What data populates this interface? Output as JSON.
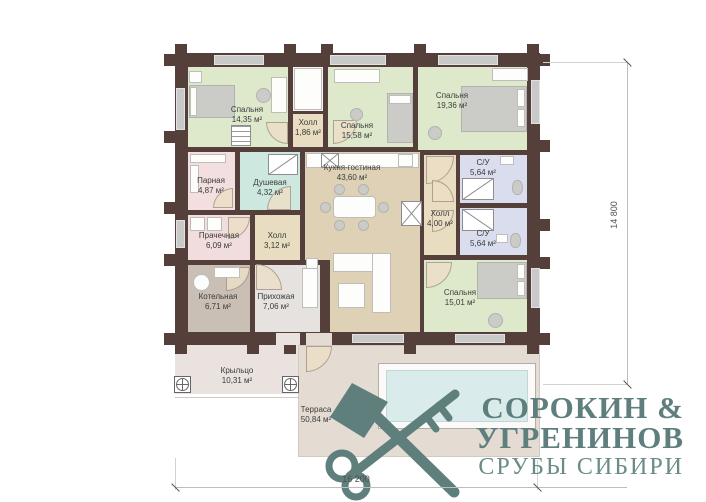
{
  "plan": {
    "rooms": [
      {
        "name": "Спальня",
        "area": "14,35 м²"
      },
      {
        "name": "Холл",
        "area": "1,86 м²"
      },
      {
        "name": "Спальня",
        "area": "15,58 м²"
      },
      {
        "name": "Спальня",
        "area": "19,36 м²"
      },
      {
        "name": "Парная",
        "area": "4,87 м²"
      },
      {
        "name": "Душевая",
        "area": "4,32 м²"
      },
      {
        "name": "Кухня-гостиная",
        "area": "43,60 м²"
      },
      {
        "name": "С/У",
        "area": "5,64 м²"
      },
      {
        "name": "Холл",
        "area": "4,00 м²"
      },
      {
        "name": "С/У",
        "area": "5,64 м²"
      },
      {
        "name": "Прачечная",
        "area": "6,09 м²"
      },
      {
        "name": "Холл",
        "area": "3,12 м²"
      },
      {
        "name": "Котельная",
        "area": "6,71 м²"
      },
      {
        "name": "Прихожая",
        "area": "7,06 м²"
      },
      {
        "name": "Спальня",
        "area": "15,01 м²"
      },
      {
        "name": "Крыльцо",
        "area": "10,31 м²"
      },
      {
        "name": "Терраса",
        "area": "50,84 м²"
      }
    ],
    "dimensions": {
      "vertical": "14 800",
      "horizontal": "16 200"
    }
  },
  "logo": {
    "name_line1": "СОРОКИН &",
    "name_line2": "УГРЕНИНОВ",
    "tagline": "СРУБЫ СИБИРИ"
  },
  "colors": {
    "wall": "#543f3b",
    "bedroom": "#dee9cc",
    "kitchen": "#ded1b5",
    "hall": "#e8ddc0",
    "sauna": "#f3dfdf",
    "shower_room": "#cde9df",
    "bathroom": "#dadded",
    "laundry": "#f1dddd",
    "boiler_room": "#cabfb5",
    "entry": "#e5e2df",
    "porch": "#e9e2de",
    "terrace": "#e4dcd3",
    "pool": "#d9eceb",
    "logo": "#5e7f7d"
  }
}
